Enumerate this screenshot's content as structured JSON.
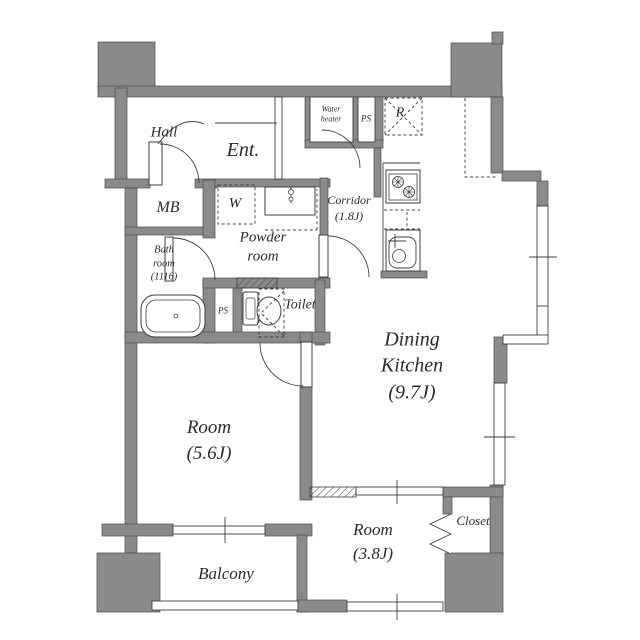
{
  "floorplan": {
    "colors": {
      "wall": "#8a8a8a",
      "line": "#3f3f3f",
      "text": "#2b2b2b",
      "bg": "#ffffff"
    },
    "rooms": {
      "hall": {
        "label": "Hall"
      },
      "entrance": {
        "label": "Ent."
      },
      "water_heater": {
        "line1": "Water",
        "line2": "heater"
      },
      "ps_upper": {
        "label": "PS"
      },
      "refrigerator": {
        "label": "R"
      },
      "meter_box": {
        "label": "MB"
      },
      "washer": {
        "label": "W"
      },
      "corridor": {
        "line1": "Corridor",
        "line2": "(1.8J)"
      },
      "powder_room": {
        "line1": "Powder",
        "line2": "room"
      },
      "bath_room": {
        "line1": "Bath",
        "line2": "room",
        "line3": "(1116)"
      },
      "ps_lower": {
        "label": "PS"
      },
      "toilet": {
        "label": "Toilet"
      },
      "dining_kitchen": {
        "line1": "Dining",
        "line2": "Kitchen",
        "line3": "(9.7J)"
      },
      "room_56": {
        "line1": "Room",
        "line2": "(5.6J)"
      },
      "room_38": {
        "line1": "Room",
        "line2": "(3.8J)"
      },
      "closet": {
        "label": "Closet"
      },
      "balcony": {
        "label": "Balcony"
      }
    }
  }
}
